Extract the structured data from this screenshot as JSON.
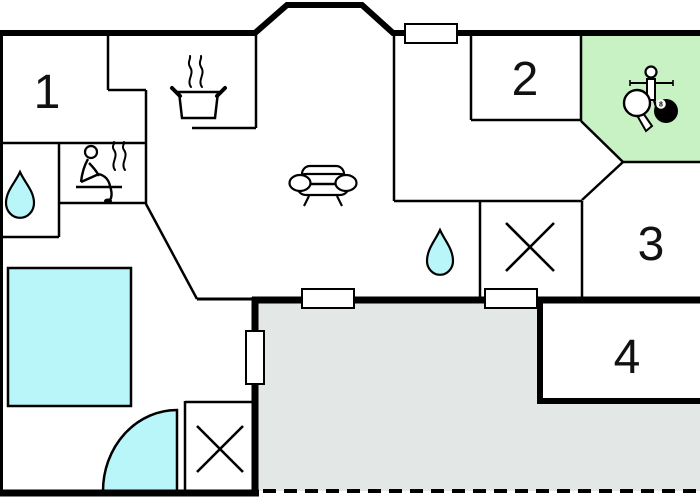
{
  "rooms": [
    {
      "label": "1"
    },
    {
      "label": "2"
    },
    {
      "label": "3"
    },
    {
      "label": "4"
    }
  ],
  "icons": {
    "billiard_ball_number": "8"
  },
  "colors": {
    "water": "#b9f6f9",
    "activity": "#c9f2c4",
    "terrace": "#e3e8e6",
    "outline": "#000000",
    "background": "#ffffff"
  }
}
